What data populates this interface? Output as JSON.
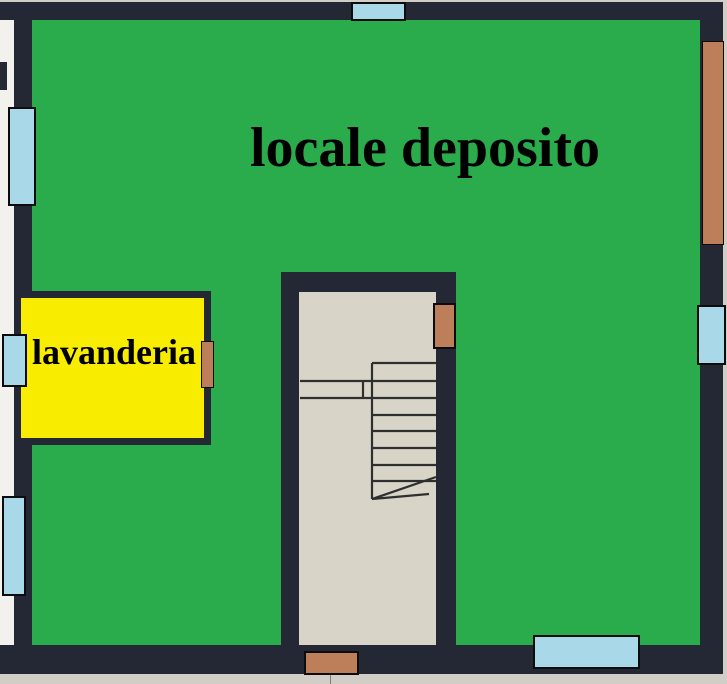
{
  "plan": {
    "type": "architectural-floor-plan",
    "rooms": [
      {
        "id": "deposito",
        "label": "locale deposito",
        "color": "#2aac4d"
      },
      {
        "id": "lavanderia",
        "label": "lavanderia",
        "color": "#f8ed00"
      },
      {
        "id": "stairwell",
        "label": "",
        "color": "#d8d5c8"
      }
    ],
    "colors": {
      "room_deposito": "#2aac4d",
      "room_lavanderia": "#f8ed00",
      "window": "#a9d9e9",
      "door": "#bd7f59",
      "wall": "#242734",
      "stairwell_floor": "#d8d5c8",
      "outside": "#d0cec7",
      "label_text": "#000000"
    },
    "elements": {
      "windows": [
        "window-top",
        "window-left-upper",
        "window-left-mid",
        "window-left-lower",
        "window-right",
        "window-bottom"
      ],
      "doors": [
        "door-right-tall",
        "door-lavanderia",
        "door-stairwell-upper",
        "door-stairwell-bottom"
      ],
      "stairs": {
        "steps_visible": 8,
        "break_line": true
      }
    }
  }
}
